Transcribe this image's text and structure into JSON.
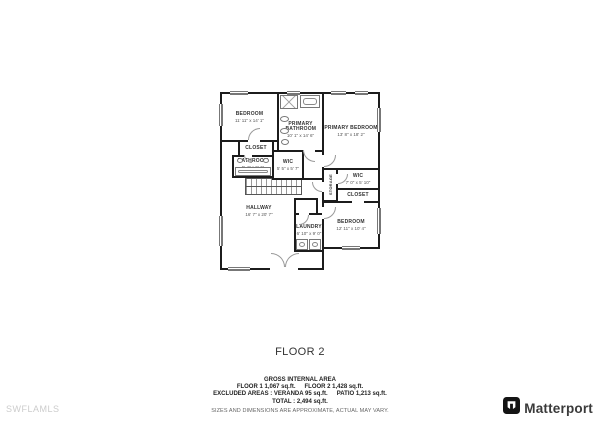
{
  "floor_title": "FLOOR 2",
  "watermark": "SWFLAMLS",
  "brand": {
    "name": "Matterport",
    "logo_icon": "matterport-cube-logo"
  },
  "footer": {
    "heading": "GROSS INTERNAL AREA",
    "line1_left": "FLOOR 1 1,067 sq.ft.",
    "line1_right": "FLOOR 2 1,428 sq.ft.",
    "line2_left": "EXCLUDED AREAS :  VERANDA 95 sq.ft.",
    "line2_right": "PATIO 1,213 sq.ft.",
    "line3": "TOTAL :  2,494 sq.ft.",
    "disclaimer": "SIZES AND DIMENSIONS ARE APPROXIMATE, ACTUAL MAY VARY."
  },
  "rooms": [
    {
      "id": "bedroom-left",
      "name": "BEDROOM",
      "dims": "11' 11\" x 14' 1\""
    },
    {
      "id": "primary-bathroom",
      "name": "PRIMARY BATHROOM",
      "dims": "10' 1\" x 14' 6\""
    },
    {
      "id": "primary-bedroom",
      "name": "PRIMARY BEDROOM",
      "dims": "13' 8\" x 18' 2\""
    },
    {
      "id": "closet-left",
      "name": "CLOSET",
      "dims": ""
    },
    {
      "id": "bathroom",
      "name": "BATHROOM",
      "dims": "5' 4\" x 9' 1\""
    },
    {
      "id": "wic-middle",
      "name": "WIC",
      "dims": "5' 5\" x 5' 7\""
    },
    {
      "id": "storage",
      "name": "STORAGE",
      "dims": ""
    },
    {
      "id": "wic-right",
      "name": "WIC",
      "dims": "7' 0\" x 5' 10\""
    },
    {
      "id": "closet-right",
      "name": "CLOSET",
      "dims": ""
    },
    {
      "id": "hallway",
      "name": "HALLWAY",
      "dims": "16' 7\" x 20' 7\""
    },
    {
      "id": "laundry",
      "name": "LAUNDRY",
      "dims": "6' 10\" x 9' 0\""
    },
    {
      "id": "bedroom-right",
      "name": "BEDROOM",
      "dims": "12' 11\" x 10' 4\""
    }
  ],
  "colors": {
    "wall": "#1c1c1c",
    "fixture": "#777777",
    "watermark": "#cccccc",
    "text": "#222222"
  }
}
